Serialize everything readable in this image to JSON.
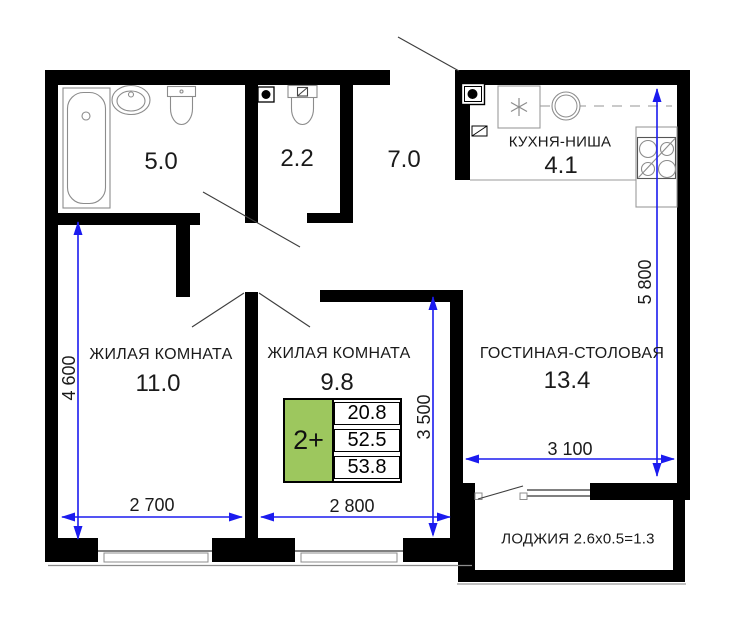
{
  "colors": {
    "dimension_blue": "#1b1bef",
    "legend_green": "#9dc75e",
    "wall_black": "#000000"
  },
  "rooms": {
    "bathroom": {
      "area": "5.0"
    },
    "wc": {
      "area": "2.2"
    },
    "hall": {
      "area": "7.0"
    },
    "kitchen_niche": {
      "label": "КУХНЯ-НИША",
      "area": "4.1"
    },
    "living_room_1": {
      "label": "ЖИЛАЯ КОМНАТА",
      "area": "11.0"
    },
    "living_room_2": {
      "label": "ЖИЛАЯ КОМНАТА",
      "area": "9.8"
    },
    "living_dining": {
      "label": "ГОСТИНАЯ-СТОЛОВАЯ",
      "area": "13.4"
    },
    "loggia": {
      "label": "ЛОДЖИЯ 2.6x0.5=1.3"
    }
  },
  "dimensions": {
    "left_height": "4 600",
    "living2_height": "3 500",
    "right_height": "5 800",
    "living1_width": "2 700",
    "living2_width": "2 800",
    "living_dining_width": "3 100"
  },
  "legend": {
    "type": "2+",
    "rows": [
      "20.8",
      "52.5",
      "53.8"
    ]
  },
  "icons": [
    "vent-icon",
    "bathtub-icon",
    "washbasin-icon",
    "toilet-icon",
    "washing-machine-icon",
    "kitchen-sink-icon",
    "stove-icon",
    "electrical-panel-icon",
    "window",
    "door-swing"
  ]
}
